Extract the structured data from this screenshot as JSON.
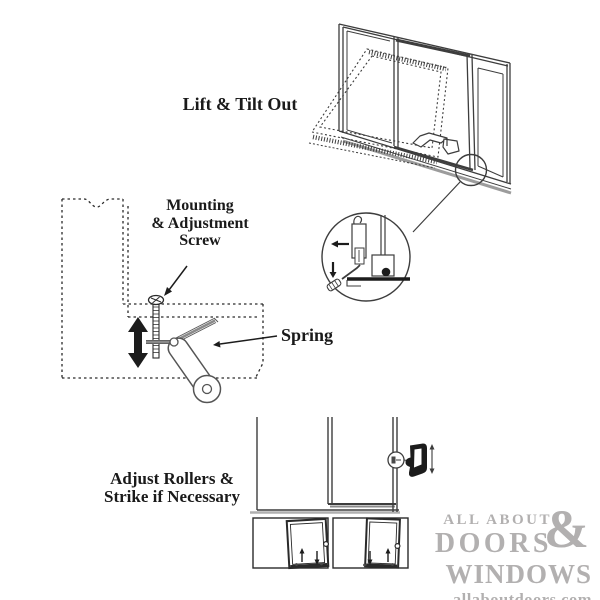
{
  "labels": {
    "lift_tilt_out": "Lift & Tilt Out",
    "mounting_adjustment_screw": "Mounting\n& Adjustment\nScrew",
    "spring": "Spring",
    "adjust_rollers_strike": "Adjust Rollers &\nStrike if Necessary"
  },
  "watermark": {
    "line1": "ALL ABOUT",
    "ampersand": "&",
    "line2": "DOORS",
    "line3": "WINDOWS",
    "website": "allaboutdoors.com",
    "color": "#b2b0b0"
  },
  "colors": {
    "line_art": "#3d3d3d",
    "dashed_outline": "#2a2a2a",
    "solid_black": "#1c1c1c",
    "roller_gray": "#8a8a8a",
    "track_gray": "#9c9c9c",
    "background": "#ffffff"
  }
}
